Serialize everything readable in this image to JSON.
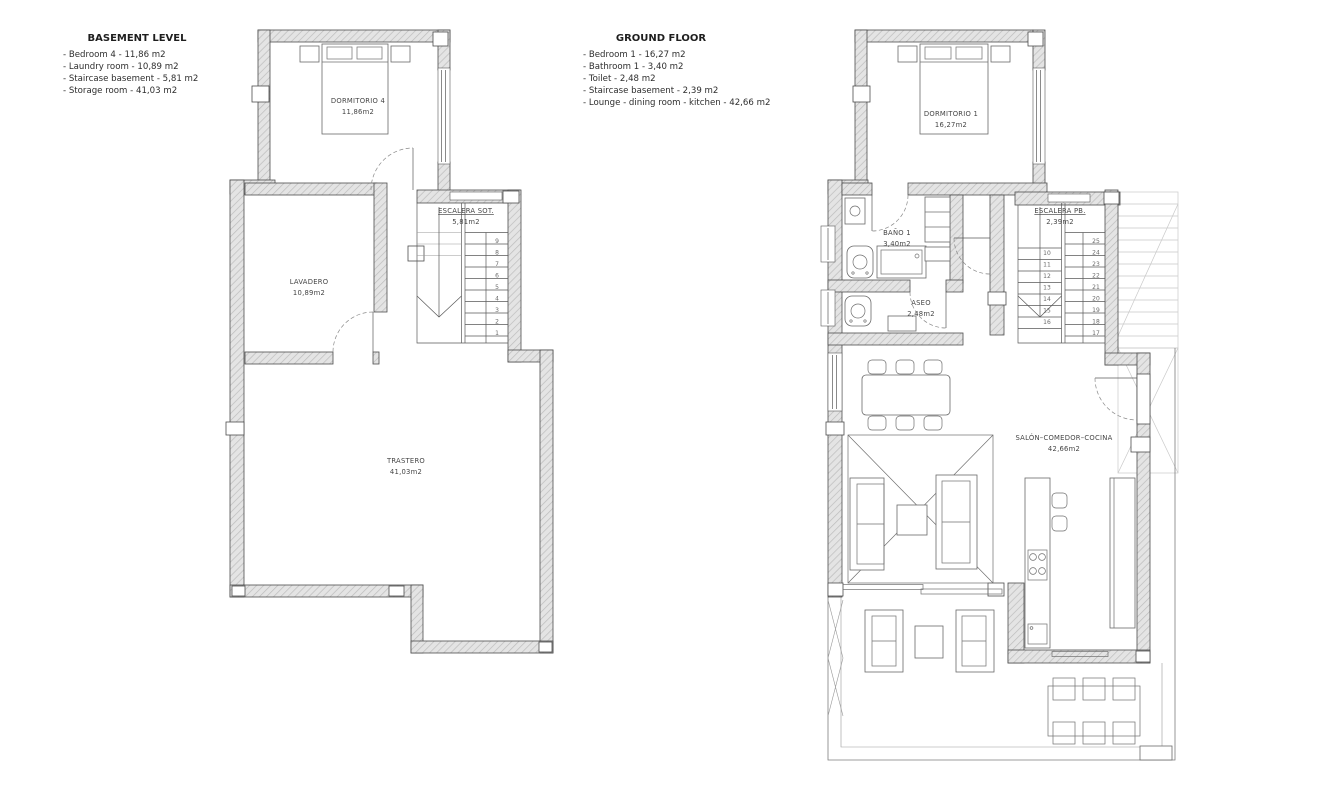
{
  "legend_basement": {
    "title": "BASEMENT LEVEL",
    "items": [
      "- Bedroom 4 - 11,86 m2",
      "- Laundry room - 10,89 m2",
      "- Staircase basement - 5,81 m2",
      "- Storage room - 41,03 m2"
    ]
  },
  "legend_ground": {
    "title": "GROUND FLOOR",
    "items": [
      "- Bedroom 1 - 16,27 m2",
      "- Bathroom 1 - 3,40 m2",
      "- Toilet - 2,48 m2",
      "- Staircase basement - 2,39 m2",
      "- Lounge - dining room - kitchen - 42,66 m2"
    ]
  },
  "basement": {
    "bedroom": {
      "name": "DORMITORIO 4",
      "area": "11,86m2"
    },
    "laundry": {
      "name": "LAVADERO",
      "area": "10,89m2"
    },
    "stairs": {
      "name": "ESCALERA SOT.",
      "area": "5,81m2",
      "steps": [
        "1",
        "2",
        "3",
        "4",
        "5",
        "6",
        "7",
        "8",
        "9"
      ]
    },
    "storage": {
      "name": "TRASTERO",
      "area": "41,03m2"
    }
  },
  "ground": {
    "bedroom": {
      "name": "DORMITORIO 1",
      "area": "16,27m2"
    },
    "bathroom": {
      "name": "BAÑO 1",
      "area": "3,40m2"
    },
    "toilet": {
      "name": "ASEO",
      "area": "2,48m2"
    },
    "stairs": {
      "name": "ESCALERA PB.",
      "area": "2,39m2",
      "steps_lower": [
        "10",
        "11",
        "12",
        "13",
        "14",
        "15",
        "16"
      ],
      "steps_upper": [
        "17",
        "18",
        "19",
        "20",
        "21",
        "22",
        "23",
        "24",
        "25"
      ]
    },
    "lounge": {
      "name": "SALÓN–COMEDOR–COCINA",
      "area": "42,66m2"
    }
  }
}
